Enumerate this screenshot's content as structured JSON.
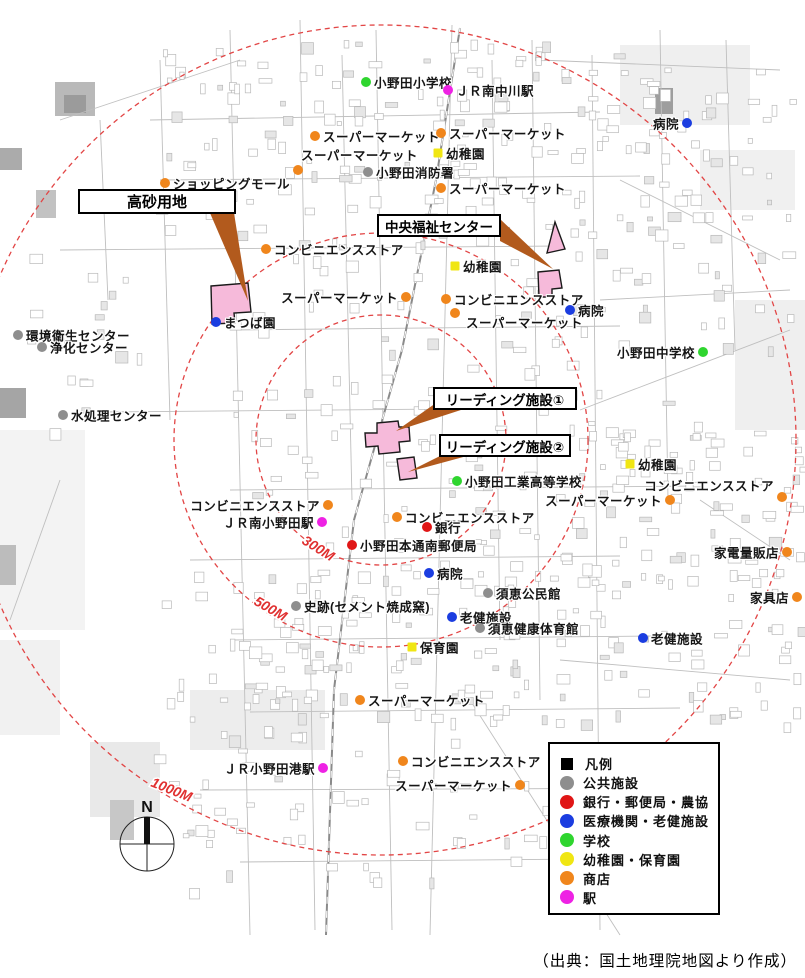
{
  "source_note": "（出典：国土地理院地図より作成）",
  "compass": {
    "label": "N",
    "cx": 147,
    "cy": 844,
    "r": 27
  },
  "colors": {
    "public": "#8e8e8e",
    "bank": "#e01616",
    "medical": "#1b3de0",
    "school": "#2fd52f",
    "kindergarten": "#f0e613",
    "shop": "#f0861c",
    "station": "#ee22e4",
    "legend": "#000000",
    "circle_stroke": "#e24545",
    "distance_label": "#e03030",
    "callout_arrow": "#b25a1d",
    "site_fill": "#f6bada",
    "site_stroke": "#1a1a1a"
  },
  "circles": {
    "cx": 381,
    "cy": 440,
    "radii": [
      125,
      207,
      415
    ],
    "labels": [
      {
        "text": "300M",
        "x": 301,
        "y": 543,
        "rot": 32
      },
      {
        "text": "500M",
        "x": 253,
        "y": 604,
        "rot": 30
      },
      {
        "text": "1000M",
        "x": 150,
        "y": 786,
        "rot": 22
      }
    ]
  },
  "callouts": [
    {
      "id": "takasago",
      "label": "高砂用地",
      "x": 78,
      "y": 189,
      "w": 158,
      "h": 25,
      "fs": 15,
      "arrow": "210,213 234,213 248,301"
    },
    {
      "id": "chuo-fukushi",
      "label": "中央福祉センター",
      "x": 377,
      "y": 214,
      "w": 124,
      "h": 23,
      "fs": 13.5,
      "arrow": "500,219 500,241 553,269"
    },
    {
      "id": "leading-1",
      "label": "リーディング施設①",
      "x": 433,
      "y": 387,
      "w": 144,
      "h": 23,
      "fs": 13.5,
      "arrow": "436,403 464,409 396,431"
    },
    {
      "id": "leading-2",
      "label": "リーディング施設②",
      "x": 439,
      "y": 434,
      "w": 132,
      "h": 23,
      "fs": 13.5,
      "arrow": "442,455 467,456 408,472"
    }
  ],
  "sites": [
    {
      "name": "takasago-site",
      "points": "211,286 248,283 251,312 234,313 235,323 212,324"
    },
    {
      "name": "fukushi-site-upper",
      "points": "555,222 565,249 547,253"
    },
    {
      "name": "fukushi-site-lower",
      "points": "538,272 559,270 562,288 552,289 552,297 539,297"
    },
    {
      "name": "leading-site-1",
      "points": "377,423 398,421 399,427 409,427 410,441 399,442 400,452 379,454 378,446 366,447 365,433 377,433"
    },
    {
      "name": "leading-site-2",
      "points": "397,459 414,457 417,478 400,480"
    }
  ],
  "markers": [
    {
      "label": "小野田小学校",
      "x": 366,
      "y": 82,
      "cat": "school",
      "side": "right"
    },
    {
      "label": "ＪＲ南中川駅",
      "x": 448,
      "y": 90,
      "cat": "station",
      "side": "right"
    },
    {
      "label": "スーパーマーケット",
      "x": 315,
      "y": 136,
      "cat": "shop",
      "side": "right"
    },
    {
      "label": "スーパーマーケット",
      "x": 441,
      "y": 133,
      "cat": "shop",
      "side": "right"
    },
    {
      "label": "スーパーマーケット",
      "x": 298,
      "y": 170,
      "cat": "shop",
      "side": "above"
    },
    {
      "label": "幼稚園",
      "x": 438,
      "y": 153,
      "cat": "kindergarten",
      "side": "right"
    },
    {
      "label": "小野田消防署",
      "x": 368,
      "y": 172,
      "cat": "public",
      "side": "right"
    },
    {
      "label": "ショッピングモール",
      "x": 165,
      "y": 183,
      "cat": "shop",
      "side": "right"
    },
    {
      "label": "スーパーマーケット",
      "x": 441,
      "y": 188,
      "cat": "shop",
      "side": "right"
    },
    {
      "label": "病院",
      "x": 687,
      "y": 123,
      "cat": "medical",
      "side": "left"
    },
    {
      "label": "コンビニエンスストア",
      "x": 266,
      "y": 249,
      "cat": "shop",
      "side": "right"
    },
    {
      "label": "幼稚園",
      "x": 455,
      "y": 266,
      "cat": "kindergarten",
      "side": "right"
    },
    {
      "label": "スーパーマーケット",
      "x": 406,
      "y": 297,
      "cat": "shop",
      "side": "left"
    },
    {
      "label": "コンビニエンスストア",
      "x": 446,
      "y": 299,
      "cat": "shop",
      "side": "right"
    },
    {
      "label": "病院",
      "x": 570,
      "y": 310,
      "cat": "medical",
      "side": "right"
    },
    {
      "label": "スーパーマーケット",
      "x": 455,
      "y": 313,
      "cat": "shop",
      "side": "right",
      "ldx": 3,
      "ldy": 9
    },
    {
      "label": "まつば園",
      "x": 216,
      "y": 322,
      "cat": "medical",
      "side": "right"
    },
    {
      "label": "環境衛生センター",
      "x": 18,
      "y": 335,
      "cat": "public",
      "side": "right"
    },
    {
      "label": "浄化センター",
      "x": 42,
      "y": 347,
      "cat": "public",
      "side": "right"
    },
    {
      "label": "小野田中学校",
      "x": 703,
      "y": 352,
      "cat": "school",
      "side": "left"
    },
    {
      "label": "水処理センター",
      "x": 63,
      "y": 415,
      "cat": "public",
      "side": "right"
    },
    {
      "label": "幼稚園",
      "x": 630,
      "y": 464,
      "cat": "kindergarten",
      "side": "right"
    },
    {
      "label": "小野田工業高等学校",
      "x": 457,
      "y": 481,
      "cat": "school",
      "side": "right"
    },
    {
      "label": "コンビニエンスストア",
      "x": 782,
      "y": 497,
      "cat": "shop",
      "side": "left",
      "ldy": -12
    },
    {
      "label": "スーパーマーケット",
      "x": 670,
      "y": 500,
      "cat": "shop",
      "side": "left"
    },
    {
      "label": "コンビニエンスストア",
      "x": 328,
      "y": 505,
      "cat": "shop",
      "side": "left"
    },
    {
      "label": "ＪＲ南小野田駅",
      "x": 322,
      "y": 522,
      "cat": "station",
      "side": "left"
    },
    {
      "label": "コンビニエンスストア",
      "x": 397,
      "y": 517,
      "cat": "shop",
      "side": "right"
    },
    {
      "label": "銀行",
      "x": 427,
      "y": 527,
      "cat": "bank",
      "side": "right"
    },
    {
      "label": "小野田本通南郵便局",
      "x": 352,
      "y": 545,
      "cat": "bank",
      "side": "right"
    },
    {
      "label": "病院",
      "x": 429,
      "y": 573,
      "cat": "medical",
      "side": "right"
    },
    {
      "label": "須恵公民館",
      "x": 488,
      "y": 593,
      "cat": "public",
      "side": "right"
    },
    {
      "label": "史跡(セメント焼成窯)",
      "x": 296,
      "y": 606,
      "cat": "public",
      "side": "right"
    },
    {
      "label": "老健施設",
      "x": 452,
      "y": 617,
      "cat": "medical",
      "side": "right"
    },
    {
      "label": "須恵健康体育館",
      "x": 480,
      "y": 628,
      "cat": "public",
      "side": "right"
    },
    {
      "label": "保育園",
      "x": 412,
      "y": 647,
      "cat": "kindergarten",
      "side": "right"
    },
    {
      "label": "家電量販店",
      "x": 787,
      "y": 552,
      "cat": "shop",
      "side": "left"
    },
    {
      "label": "家具店",
      "x": 797,
      "y": 597,
      "cat": "shop",
      "side": "left"
    },
    {
      "label": "老健施設",
      "x": 643,
      "y": 638,
      "cat": "medical",
      "side": "right"
    },
    {
      "label": "スーパーマーケット",
      "x": 360,
      "y": 700,
      "cat": "shop",
      "side": "right"
    },
    {
      "label": "コンビニエンスストア",
      "x": 403,
      "y": 761,
      "cat": "shop",
      "side": "right"
    },
    {
      "label": "ＪＲ小野田港駅",
      "x": 323,
      "y": 768,
      "cat": "station",
      "side": "left"
    },
    {
      "label": "スーパーマーケット",
      "x": 520,
      "y": 785,
      "cat": "shop",
      "side": "left"
    }
  ],
  "legend": {
    "x": 548,
    "y": 742,
    "w": 172,
    "h": 173,
    "rows": [
      {
        "label": "凡例",
        "cat": "legend",
        "shape": "square"
      },
      {
        "label": "公共施設",
        "cat": "public",
        "shape": "circle"
      },
      {
        "label": "銀行・郵便局・農協",
        "cat": "bank",
        "shape": "circle"
      },
      {
        "label": "医療機関・老健施設",
        "cat": "medical",
        "shape": "circle"
      },
      {
        "label": "学校",
        "cat": "school",
        "shape": "circle"
      },
      {
        "label": "幼稚園・保育園",
        "cat": "kindergarten",
        "shape": "circle"
      },
      {
        "label": "商店",
        "cat": "shop",
        "shape": "circle"
      },
      {
        "label": "駅",
        "cat": "station",
        "shape": "circle"
      }
    ]
  }
}
